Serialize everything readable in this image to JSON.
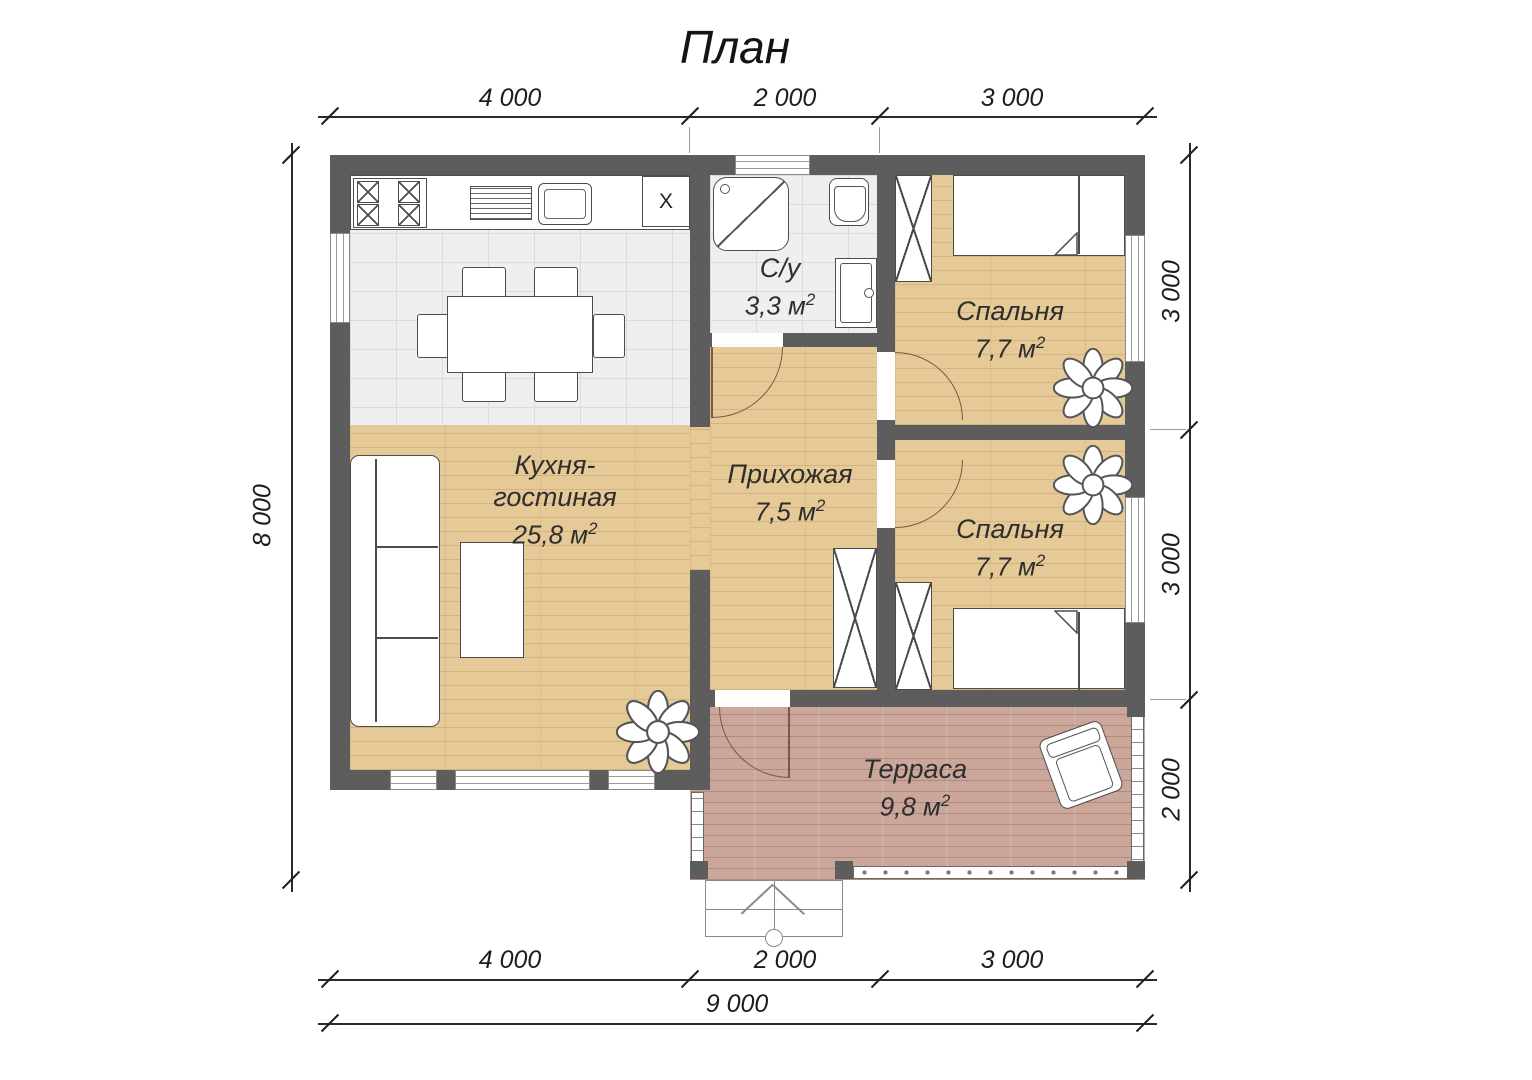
{
  "title": "План",
  "rooms": {
    "kitchen": {
      "name_lines": [
        "Кухня-",
        "гостиная"
      ],
      "area": "25,8 м",
      "area_sup": "2",
      "appliance_mark": "X"
    },
    "bathroom": {
      "name": "С/у",
      "area": "3,3 м",
      "area_sup": "2"
    },
    "hallway": {
      "name": "Прихожая",
      "area": "7,5 м",
      "area_sup": "2"
    },
    "bedroom1": {
      "name": "Спальня",
      "area": "7,7 м",
      "area_sup": "2"
    },
    "bedroom2": {
      "name": "Спальня",
      "area": "7,7 м",
      "area_sup": "2"
    },
    "terrace": {
      "name": "Терраса",
      "area": "9,8 м",
      "area_sup": "2"
    }
  },
  "dimensions": {
    "top": [
      "4 000",
      "2 000",
      "3 000"
    ],
    "bottom": [
      "4 000",
      "2 000",
      "3 000"
    ],
    "total": "9 000",
    "left": "8 000",
    "right": [
      "3 000",
      "3 000",
      "2 000"
    ]
  },
  "colors": {
    "wall": "#5d5d5d",
    "wood_floor": "#e5c997",
    "tile_floor": "#edeff1",
    "terrace_floor": "#cba69a"
  }
}
